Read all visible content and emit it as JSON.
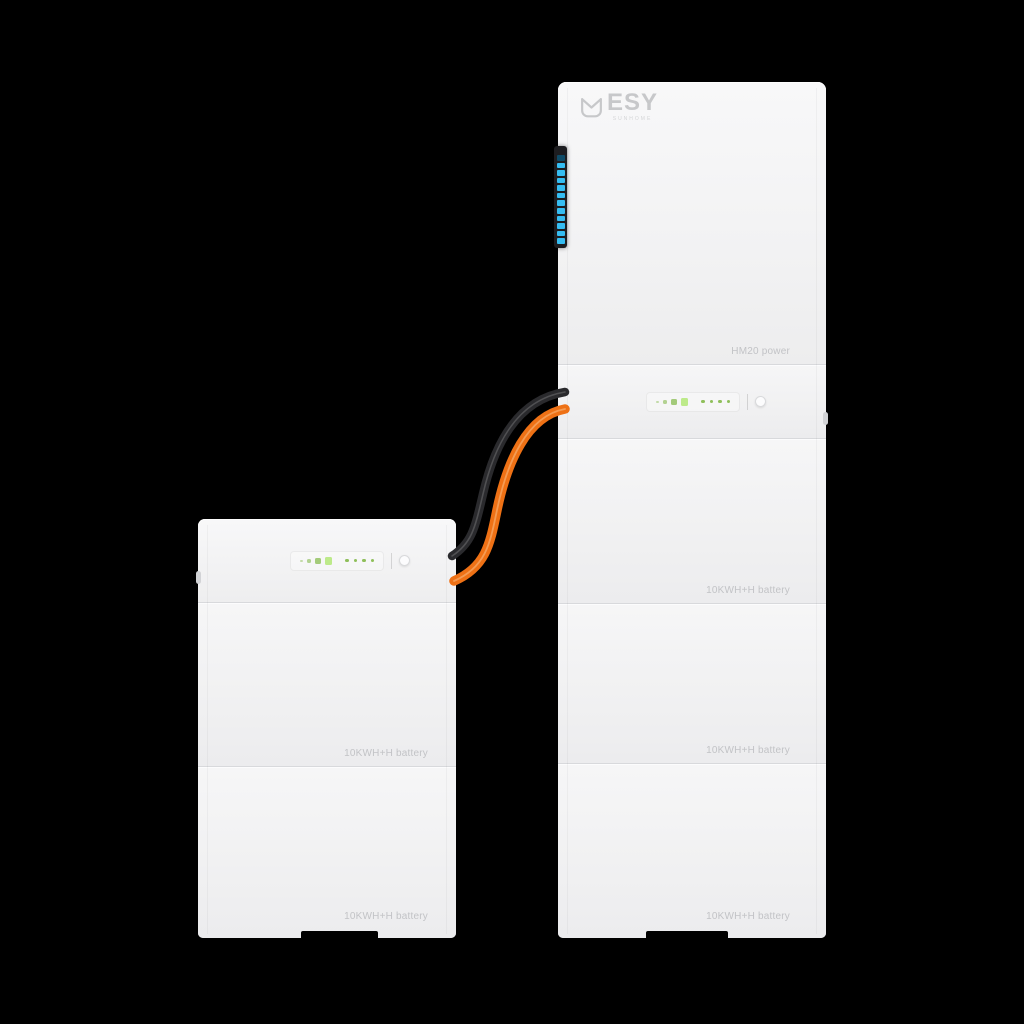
{
  "scene": {
    "background": "#000000"
  },
  "brand": {
    "name": "ESY",
    "subtext": "SUNHOME",
    "color": "#c7c8ca"
  },
  "tower_unit": {
    "power_module_label": "HM20 power",
    "battery_modules": [
      {
        "label": "10KWH+H battery"
      },
      {
        "label": "10KWH+H battery"
      },
      {
        "label": "10KWH+H battery"
      }
    ],
    "led_strip": {
      "segment_count": 12,
      "on_color": "#35bdf2",
      "off_color": "#0e4a66",
      "body_color": "#1d1d20"
    },
    "indicator_panel": {
      "bar_count": 4,
      "dot_count": 4,
      "led_color": "#8fbf5a",
      "button": "power"
    }
  },
  "stack_unit": {
    "battery_modules": [
      {
        "label": "10KWH+H battery"
      },
      {
        "label": "10KWH+H battery"
      }
    ],
    "indicator_panel": {
      "bar_count": 4,
      "dot_count": 4,
      "led_color": "#8fbf5a",
      "button": "power"
    }
  },
  "cables": [
    {
      "name": "dc-cable-black",
      "color": "#2a2a2d"
    },
    {
      "name": "dc-cable-orange",
      "color": "#ee7115"
    }
  ],
  "colors": {
    "unit_body": "#f1f1f2",
    "divider": "#d8d9dc",
    "label_text": "#c2c3c6"
  }
}
